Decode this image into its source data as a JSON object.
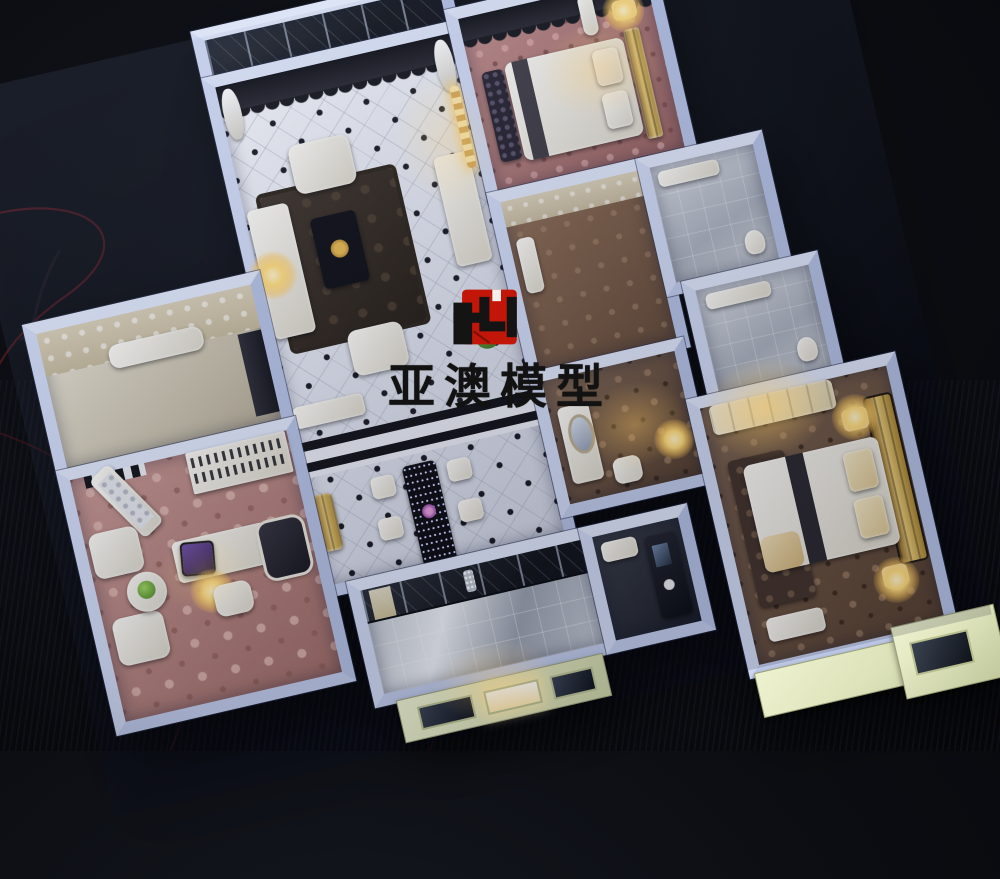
{
  "watermark": {
    "brand_text": "亚澳模型",
    "logo": {
      "red": "#c21708",
      "black": "#141414"
    }
  },
  "scene": {
    "background_color": "#0b0d12",
    "wall_color": "#c7d1ec",
    "facade_color": "#dfe5b4",
    "warm_light_color": "#ffd978",
    "pink_carpet_color": "#b57f7c",
    "brown_carpet_color": "#6b5243",
    "tile_floor_color": "#e9ebf1",
    "wire_color": "#6b1d26"
  }
}
